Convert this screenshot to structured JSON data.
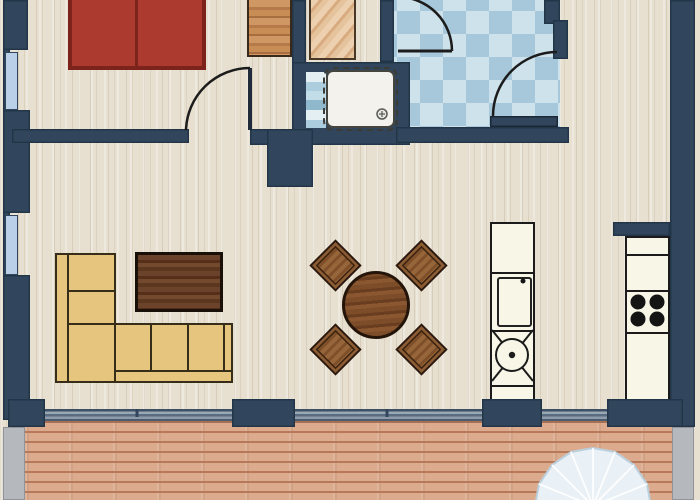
{
  "plan": {
    "kind": "apartment floor plan, top-down architectural drawing, no text labels visible",
    "palette": {
      "wall_navy": "#31465c",
      "floor_beige": "#e7e0d0",
      "floor_grain": "#d6cdbb",
      "bath_tile_light": "#cde2eb",
      "bath_tile_medium": "#a6c8da",
      "window_pane_blue": "#b9d0e8",
      "bed_red": "#ad3a2e",
      "bed_border_red": "#7c241c",
      "wardrobe_wood": "#c98e5b",
      "closet_wood_pale": "#e6c3a0",
      "sofa_tan": "#e6c57e",
      "coffee_table_brown": "#5f3a22",
      "dining_table_brown": "#7a4a28",
      "chair_brown": "#8d5c33",
      "cabinet_white": "#f7f6e7",
      "deck_plank_salmon": "#dcab8d",
      "deck_plank_line": "#b8795a",
      "concrete_gray": "#b5b8bc",
      "parasol_light_blue": "#e9f0f6",
      "outline_black": "#1b1b1b",
      "shower_tray_white": "#f3f2ed"
    },
    "rooms": [
      {
        "name": "bedroom",
        "features": [
          "double bed with 2 red mattresses",
          "wood wardrobe",
          "swing door to living area"
        ]
      },
      {
        "name": "closet-niche",
        "features": [
          "pale wood wardrobe"
        ]
      },
      {
        "name": "bathroom",
        "features": [
          "blue checkered tile floor",
          "shower tray with drain",
          "two swing doors"
        ]
      },
      {
        "name": "living-dining-area",
        "features": [
          "L-shaped tan sofa",
          "dark coffee table",
          "round dining table",
          "4 diamond-set chairs"
        ]
      },
      {
        "name": "kitchen",
        "features": [
          "island unit with oven door and round sink",
          "wall unit with 4-burner cooktop"
        ]
      },
      {
        "name": "hallway",
        "features": [
          "open wood floor corridor"
        ]
      },
      {
        "name": "terrace",
        "features": [
          "horizontal wood plank deck",
          "parasol canopy at edge",
          "sliding glass front with navy posts",
          "gray concrete side strips"
        ]
      }
    ],
    "counts": {
      "left_wall_windows": 2,
      "door_swing_arcs": 3,
      "dining_chairs": 4,
      "cooktop_burners": 4,
      "bed_mattresses": 2,
      "terrace_posts": 4,
      "kitchen_units": 2
    }
  }
}
